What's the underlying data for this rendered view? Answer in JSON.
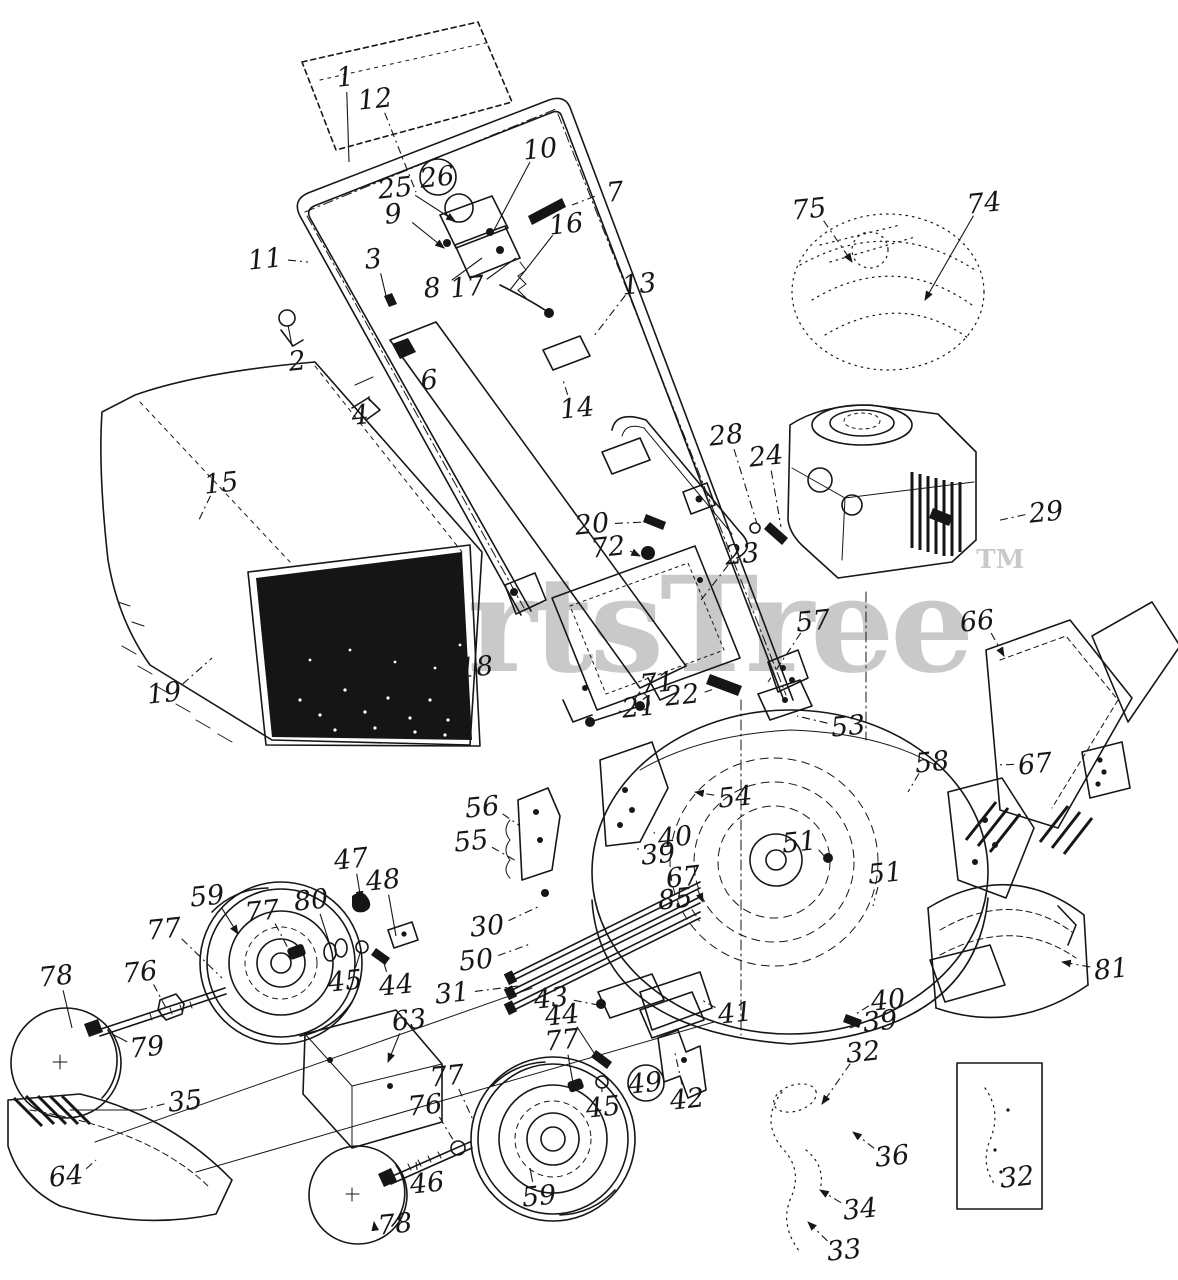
{
  "watermark": {
    "text": "PartsTree",
    "tm": "TM"
  },
  "colors": {
    "ink": "#161616",
    "watermark": "#c9c9c9",
    "paper": "#ffffff"
  },
  "diagram": {
    "kind": "exploded-parts-diagram",
    "labels": [
      {
        "t": "1",
        "x": 346,
        "y": 86,
        "lx": 349,
        "ly": 162
      },
      {
        "t": "12",
        "x": 376,
        "y": 108,
        "lx": 416,
        "ly": 192,
        "dash": 1
      },
      {
        "t": "10",
        "x": 541,
        "y": 158,
        "lx": 493,
        "ly": 232
      },
      {
        "t": "7",
        "x": 616,
        "y": 201,
        "lx": 572,
        "ly": 205,
        "dash": 1
      },
      {
        "t": "25",
        "x": 396,
        "y": 197,
        "lx": 455,
        "ly": 221,
        "arrow": 1
      },
      {
        "t": "26",
        "x": 438,
        "y": 186,
        "c": 1
      },
      {
        "t": "9",
        "x": 394,
        "y": 223,
        "lx": 444,
        "ly": 248,
        "arrow": 1
      },
      {
        "t": "16",
        "x": 567,
        "y": 233,
        "lx": 510,
        "ly": 290
      },
      {
        "t": "8",
        "x": 433,
        "y": 297,
        "lx": 482,
        "ly": 258
      },
      {
        "t": "17",
        "x": 468,
        "y": 296,
        "lx": 516,
        "ly": 258
      },
      {
        "t": "11",
        "x": 266,
        "y": 268,
        "lx": 308,
        "ly": 262,
        "dash": 1
      },
      {
        "t": "3",
        "x": 374,
        "y": 268,
        "lx": 387,
        "ly": 300
      },
      {
        "t": "13",
        "x": 640,
        "y": 293,
        "lx": 594,
        "ly": 336,
        "dash": 1
      },
      {
        "t": "2",
        "x": 298,
        "y": 370,
        "lx": 288,
        "ly": 325
      },
      {
        "t": "4",
        "x": 361,
        "y": 424,
        "lx": 369,
        "ly": 396
      },
      {
        "t": "6",
        "x": 430,
        "y": 389,
        "lx": 406,
        "ly": 362
      },
      {
        "t": "14",
        "x": 578,
        "y": 417,
        "lx": 563,
        "ly": 380,
        "dash": 1
      },
      {
        "t": "15",
        "x": 222,
        "y": 492,
        "lx": 198,
        "ly": 522,
        "dash": 1
      },
      {
        "t": "19",
        "x": 165,
        "y": 702,
        "lx": 212,
        "ly": 658,
        "dash": 1
      },
      {
        "t": "18",
        "x": 477,
        "y": 676,
        "lx": 462,
        "ly": 670,
        "dash": 1
      },
      {
        "t": "20",
        "x": 593,
        "y": 533,
        "lx": 646,
        "ly": 522,
        "dash": 1
      },
      {
        "t": "72",
        "x": 609,
        "y": 556,
        "lx": 640,
        "ly": 556,
        "arrow": 1
      },
      {
        "t": "23",
        "x": 743,
        "y": 563,
        "lx": 701,
        "ly": 600,
        "dash": 1
      },
      {
        "t": "71",
        "x": 658,
        "y": 692,
        "lx": 634,
        "ly": 700,
        "dash": 1
      },
      {
        "t": "21",
        "x": 640,
        "y": 716,
        "lx": 622,
        "ly": 712
      },
      {
        "t": "22",
        "x": 683,
        "y": 704,
        "lx": 714,
        "ly": 689,
        "dash": 1
      },
      {
        "t": "57",
        "x": 814,
        "y": 630,
        "lx": 768,
        "ly": 682,
        "dash": 1
      },
      {
        "t": "53",
        "x": 849,
        "y": 735,
        "lx": 797,
        "ly": 716,
        "dash": 1
      },
      {
        "t": "28",
        "x": 727,
        "y": 444,
        "lx": 757,
        "ly": 524,
        "dash": 1
      },
      {
        "t": "24",
        "x": 767,
        "y": 465,
        "lx": 781,
        "ly": 527,
        "dash": 1
      },
      {
        "t": "29",
        "x": 1047,
        "y": 521,
        "lx": 996,
        "ly": 521,
        "dash": 1
      },
      {
        "t": "75",
        "x": 810,
        "y": 218,
        "lx": 852,
        "ly": 262,
        "arrow": 1,
        "dash": 1
      },
      {
        "t": "74",
        "x": 985,
        "y": 212,
        "lx": 925,
        "ly": 300,
        "arrow": 1
      },
      {
        "t": "66",
        "x": 978,
        "y": 630,
        "lx": 1004,
        "ly": 656,
        "arrow": 1,
        "dash": 1
      },
      {
        "t": "67",
        "x": 1036,
        "y": 773,
        "lx": 996,
        "ly": 765,
        "dash": 1
      },
      {
        "t": "58",
        "x": 933,
        "y": 771,
        "lx": 908,
        "ly": 792,
        "dash": 1
      },
      {
        "t": "54",
        "x": 736,
        "y": 806,
        "lx": 695,
        "ly": 792,
        "arrow": 1,
        "dash": 1
      },
      {
        "t": "51",
        "x": 800,
        "y": 851,
        "lx": 826,
        "ly": 858
      },
      {
        "t": "51",
        "x": 886,
        "y": 882,
        "lx": 873,
        "ly": 906,
        "dash": 1
      },
      {
        "t": "40",
        "x": 676,
        "y": 846,
        "lx": 654,
        "ly": 832,
        "dash": 1
      },
      {
        "t": "39",
        "x": 659,
        "y": 863,
        "lx": 638,
        "ly": 848
      },
      {
        "t": "67",
        "x": 684,
        "y": 886,
        "lx": 703,
        "ly": 902,
        "arrow": 1
      },
      {
        "t": "85",
        "x": 676,
        "y": 908,
        "lx": 700,
        "ly": 922,
        "dash": 1
      },
      {
        "t": "59",
        "x": 208,
        "y": 905,
        "lx": 238,
        "ly": 934,
        "arrow": 1
      },
      {
        "t": "77",
        "x": 165,
        "y": 938,
        "lx": 222,
        "ly": 978,
        "dash": 1
      },
      {
        "t": "77",
        "x": 263,
        "y": 920,
        "lx": 290,
        "ly": 952,
        "dash": 1
      },
      {
        "t": "76",
        "x": 141,
        "y": 981,
        "lx": 166,
        "ly": 1008,
        "dash": 1
      },
      {
        "t": "78",
        "x": 57,
        "y": 985,
        "lx": 72,
        "ly": 1028
      },
      {
        "t": "79",
        "x": 148,
        "y": 1056,
        "lx": 112,
        "ly": 1034
      },
      {
        "t": "80",
        "x": 312,
        "y": 909,
        "lx": 331,
        "ly": 948
      },
      {
        "t": "47",
        "x": 352,
        "y": 868,
        "lx": 361,
        "ly": 900,
        "arrow": 1
      },
      {
        "t": "48",
        "x": 384,
        "y": 889,
        "lx": 396,
        "ly": 936
      },
      {
        "t": "45",
        "x": 346,
        "y": 990,
        "lx": 361,
        "ly": 950
      },
      {
        "t": "44",
        "x": 397,
        "y": 994,
        "lx": 382,
        "ly": 957
      },
      {
        "t": "63",
        "x": 410,
        "y": 1029,
        "lx": 388,
        "ly": 1062,
        "arrow": 1
      },
      {
        "t": "55",
        "x": 472,
        "y": 850,
        "lx": 518,
        "ly": 862,
        "dash": 1
      },
      {
        "t": "56",
        "x": 483,
        "y": 816,
        "lx": 520,
        "ly": 826,
        "dash": 1
      },
      {
        "t": "30",
        "x": 488,
        "y": 935,
        "lx": 540,
        "ly": 906,
        "dash": 1
      },
      {
        "t": "50",
        "x": 477,
        "y": 969,
        "lx": 530,
        "ly": 944,
        "dash": 1
      },
      {
        "t": "31",
        "x": 453,
        "y": 1002,
        "lx": 518,
        "ly": 986,
        "dash": 1
      },
      {
        "t": "43",
        "x": 552,
        "y": 1007,
        "lx": 598,
        "ly": 1005,
        "dash": 1
      },
      {
        "t": "44",
        "x": 563,
        "y": 1024,
        "lx": 594,
        "ly": 1053
      },
      {
        "t": "77",
        "x": 563,
        "y": 1049,
        "lx": 573,
        "ly": 1083
      },
      {
        "t": "45",
        "x": 604,
        "y": 1116,
        "lx": 602,
        "ly": 1087
      },
      {
        "t": "49",
        "x": 646,
        "y": 1092,
        "c": 1
      },
      {
        "t": "42",
        "x": 688,
        "y": 1108,
        "lx": 675,
        "ly": 1053,
        "dash": 1
      },
      {
        "t": "41",
        "x": 736,
        "y": 1022,
        "lx": 702,
        "ly": 1000,
        "dash": 1
      },
      {
        "t": "40",
        "x": 889,
        "y": 1009,
        "lx": 856,
        "ly": 1014,
        "dash": 1
      },
      {
        "t": "39",
        "x": 881,
        "y": 1030,
        "lx": 850,
        "ly": 1028
      },
      {
        "t": "32",
        "x": 864,
        "y": 1061,
        "lx": 822,
        "ly": 1104,
        "arrow": 1,
        "dash": 1
      },
      {
        "t": "36",
        "x": 893,
        "y": 1165,
        "lx": 853,
        "ly": 1132,
        "arrow": 1,
        "dash": 1
      },
      {
        "t": "34",
        "x": 861,
        "y": 1218,
        "lx": 820,
        "ly": 1190,
        "arrow": 1,
        "dash": 1
      },
      {
        "t": "33",
        "x": 845,
        "y": 1259,
        "lx": 808,
        "ly": 1222,
        "arrow": 1,
        "dash": 1
      },
      {
        "t": "81",
        "x": 1112,
        "y": 978,
        "lx": 1062,
        "ly": 962,
        "arrow": 1,
        "dash": 1
      },
      {
        "t": "64",
        "x": 67,
        "y": 1185,
        "lx": 96,
        "ly": 1160,
        "dash": 1
      },
      {
        "t": "35",
        "x": 186,
        "y": 1110,
        "lx": 140,
        "ly": 1110,
        "dash": 1
      },
      {
        "t": "77",
        "x": 448,
        "y": 1085,
        "lx": 474,
        "ly": 1122,
        "dash": 1
      },
      {
        "t": "76",
        "x": 426,
        "y": 1114,
        "lx": 455,
        "ly": 1143,
        "dash": 1
      },
      {
        "t": "46",
        "x": 428,
        "y": 1192,
        "lx": 416,
        "ly": 1162
      },
      {
        "t": "59",
        "x": 540,
        "y": 1205,
        "lx": 530,
        "ly": 1168
      },
      {
        "t": "78",
        "x": 396,
        "y": 1233,
        "lx": 374,
        "ly": 1222,
        "arrow": 1
      },
      {
        "t": "32",
        "x": 1018,
        "y": 1186
      }
    ]
  }
}
